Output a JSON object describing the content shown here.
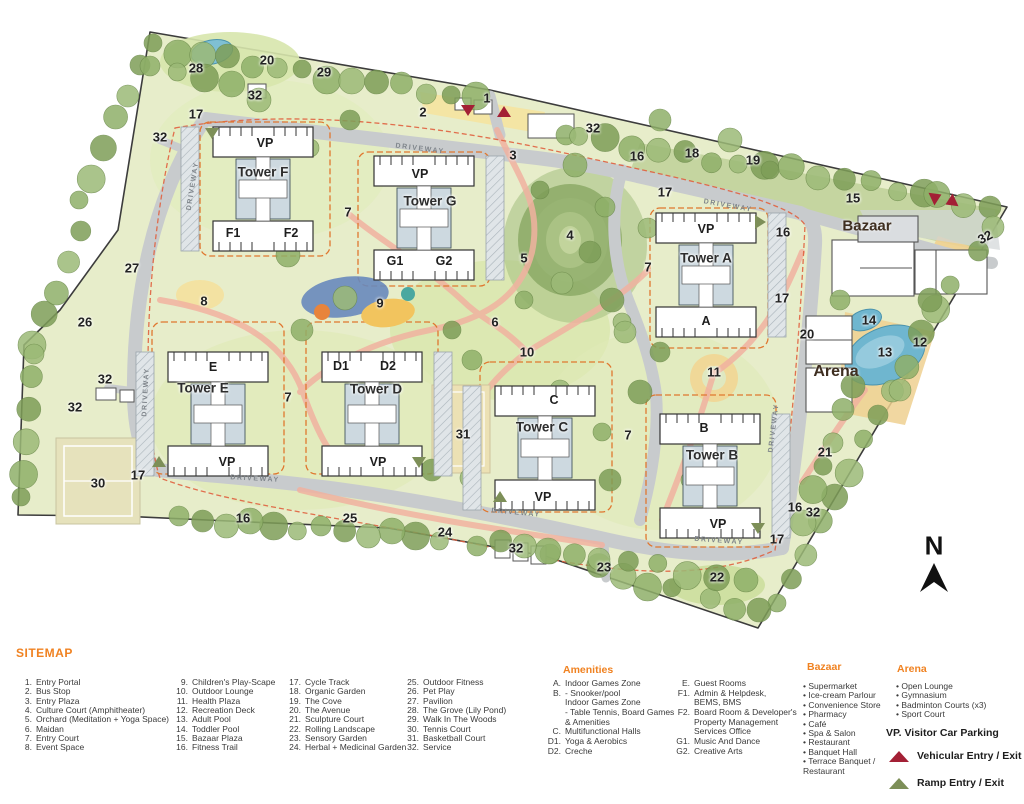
{
  "legend": {
    "title": "SITEMAP",
    "sitemap_items": [
      {
        "num": "1.",
        "label": "Entry Portal"
      },
      {
        "num": "2.",
        "label": "Bus Stop"
      },
      {
        "num": "3.",
        "label": "Entry Plaza"
      },
      {
        "num": "4.",
        "label": "Culture Court (Amphitheater)"
      },
      {
        "num": "5.",
        "label": "Orchard (Meditation + Yoga Space)"
      },
      {
        "num": "6.",
        "label": "Maidan"
      },
      {
        "num": "7.",
        "label": "Entry Court"
      },
      {
        "num": "8.",
        "label": "Event Space"
      },
      {
        "num": "9.",
        "label": "Children's Play-Scape"
      },
      {
        "num": "10.",
        "label": "Outdoor Lounge"
      },
      {
        "num": "11.",
        "label": "Health Plaza"
      },
      {
        "num": "12.",
        "label": "Recreation Deck"
      },
      {
        "num": "13.",
        "label": "Adult Pool"
      },
      {
        "num": "14.",
        "label": "Toddler Pool"
      },
      {
        "num": "15.",
        "label": "Bazaar Plaza"
      },
      {
        "num": "16.",
        "label": "Fitness Trail"
      },
      {
        "num": "17.",
        "label": "Cycle Track"
      },
      {
        "num": "18.",
        "label": "Organic Garden"
      },
      {
        "num": "19.",
        "label": "The Cove"
      },
      {
        "num": "20.",
        "label": "The Avenue"
      },
      {
        "num": "21.",
        "label": "Sculpture Court"
      },
      {
        "num": "22.",
        "label": "Rolling Landscape"
      },
      {
        "num": "23.",
        "label": "Sensory Garden"
      },
      {
        "num": "24.",
        "label": "Herbal + Medicinal Garden"
      },
      {
        "num": "25.",
        "label": "Outdoor Fitness"
      },
      {
        "num": "26.",
        "label": "Pet Play"
      },
      {
        "num": "27.",
        "label": "Pavilion"
      },
      {
        "num": "28.",
        "label": "The Grove (Lily Pond)"
      },
      {
        "num": "29.",
        "label": "Walk In The Woods"
      },
      {
        "num": "30.",
        "label": "Tennis Court"
      },
      {
        "num": "31.",
        "label": "Basketball Court"
      },
      {
        "num": "32.",
        "label": "Service"
      }
    ],
    "amenities": {
      "title": "Amenities",
      "items": [
        {
          "key": "A.",
          "lines": [
            "Indoor Games Zone"
          ]
        },
        {
          "key": "B.",
          "lines": [
            "- Snooker/pool",
            "Indoor Games Zone",
            "- Table Tennis, Board Games",
            "  & Amenities"
          ]
        },
        {
          "key": "C.",
          "lines": [
            "Multifunctional Halls"
          ]
        },
        {
          "key": "D1.",
          "lines": [
            "Yoga & Aerobics"
          ]
        },
        {
          "key": "D2.",
          "lines": [
            "Creche"
          ]
        }
      ]
    },
    "facilities": {
      "items": [
        {
          "key": "E.",
          "lines": [
            "Guest Rooms"
          ]
        },
        {
          "key": "F1.",
          "lines": [
            "Admin & Helpdesk,",
            "BEMS, BMS"
          ]
        },
        {
          "key": "F2.",
          "lines": [
            "Board Room & Developer's",
            "Property Management",
            "Services Office"
          ]
        },
        {
          "key": "G1.",
          "lines": [
            "Music And Dance"
          ]
        },
        {
          "key": "G2.",
          "lines": [
            "Creative Arts"
          ]
        }
      ]
    },
    "bazaar": {
      "title": "Bazaar",
      "items": [
        "Supermarket",
        "Ice-cream Parlour",
        "Convenience Store",
        "Pharmacy",
        "Café",
        "Spa & Salon",
        "Restaurant",
        "Banquet Hall",
        "Terrace Banquet /\nRestaurant"
      ]
    },
    "arena": {
      "title": "Arena",
      "items": [
        "Open Lounge",
        "Gymnasium",
        "Badminton Courts (x3)",
        "Sport Court"
      ]
    },
    "vp_note": "VP. Visitor Car Parking",
    "entries": [
      {
        "label": "Vehicular Entry / Exit",
        "color": "#a32035",
        "type": "vehicular"
      },
      {
        "label": "Ramp Entry / Exit",
        "color": "#7d8f58",
        "type": "ramp"
      }
    ]
  },
  "site_plan": {
    "compass": {
      "label": "N"
    },
    "area_labels": [
      {
        "t": "Bazaar",
        "x": 867,
        "y": 226,
        "s": 15
      },
      {
        "t": "Arena",
        "x": 836,
        "y": 372,
        "s": 16
      }
    ],
    "tower_labels": [
      {
        "t": "Tower F",
        "x": 263,
        "y": 172
      },
      {
        "t": "Tower G",
        "x": 430,
        "y": 201
      },
      {
        "t": "Tower A",
        "x": 706,
        "y": 258
      },
      {
        "t": "Tower E",
        "x": 203,
        "y": 388
      },
      {
        "t": "Tower D",
        "x": 376,
        "y": 389
      },
      {
        "t": "Tower C",
        "x": 542,
        "y": 427
      },
      {
        "t": "Tower B",
        "x": 712,
        "y": 455
      }
    ],
    "unit_labels": [
      {
        "t": "VP",
        "x": 265,
        "y": 143
      },
      {
        "t": "F1",
        "x": 233,
        "y": 233
      },
      {
        "t": "F2",
        "x": 291,
        "y": 233
      },
      {
        "t": "VP",
        "x": 420,
        "y": 174
      },
      {
        "t": "G1",
        "x": 395,
        "y": 261
      },
      {
        "t": "G2",
        "x": 444,
        "y": 261
      },
      {
        "t": "VP",
        "x": 706,
        "y": 229
      },
      {
        "t": "A",
        "x": 706,
        "y": 321
      },
      {
        "t": "E",
        "x": 213,
        "y": 367
      },
      {
        "t": "VP",
        "x": 227,
        "y": 462
      },
      {
        "t": "D1",
        "x": 341,
        "y": 366
      },
      {
        "t": "D2",
        "x": 388,
        "y": 366
      },
      {
        "t": "VP",
        "x": 378,
        "y": 462
      },
      {
        "t": "C",
        "x": 554,
        "y": 400
      },
      {
        "t": "VP",
        "x": 543,
        "y": 497
      },
      {
        "t": "B",
        "x": 704,
        "y": 428
      },
      {
        "t": "VP",
        "x": 718,
        "y": 524
      }
    ],
    "driveway_labels": [
      {
        "t": "DRIVEWAY",
        "x": 420,
        "y": 149,
        "r": 7
      },
      {
        "t": "DRIVEWAY",
        "x": 728,
        "y": 206,
        "r": 10
      },
      {
        "t": "DRIVEWAY",
        "x": 193,
        "y": 186,
        "r": -81
      },
      {
        "t": "DRIVEWAY",
        "x": 146,
        "y": 392,
        "r": -87
      },
      {
        "t": "DRIVEWAY",
        "x": 255,
        "y": 479,
        "r": 3
      },
      {
        "t": "DRIVEWAY",
        "x": 516,
        "y": 513,
        "r": 5
      },
      {
        "t": "DRIVEWAY",
        "x": 719,
        "y": 541,
        "r": 4
      },
      {
        "t": "DRIVEWAY",
        "x": 774,
        "y": 428,
        "r": -83
      }
    ],
    "markers": [
      {
        "t": "1",
        "x": 487,
        "y": 98
      },
      {
        "t": "2",
        "x": 423,
        "y": 112
      },
      {
        "t": "3",
        "x": 513,
        "y": 155
      },
      {
        "t": "4",
        "x": 570,
        "y": 235
      },
      {
        "t": "5",
        "x": 524,
        "y": 258
      },
      {
        "t": "6",
        "x": 495,
        "y": 322
      },
      {
        "t": "7",
        "x": 348,
        "y": 212
      },
      {
        "t": "7",
        "x": 648,
        "y": 267
      },
      {
        "t": "7",
        "x": 288,
        "y": 397
      },
      {
        "t": "7",
        "x": 628,
        "y": 435
      },
      {
        "t": "8",
        "x": 204,
        "y": 301
      },
      {
        "t": "9",
        "x": 380,
        "y": 303
      },
      {
        "t": "10",
        "x": 527,
        "y": 352
      },
      {
        "t": "11",
        "x": 714,
        "y": 372
      },
      {
        "t": "12",
        "x": 920,
        "y": 342
      },
      {
        "t": "13",
        "x": 885,
        "y": 352
      },
      {
        "t": "14",
        "x": 869,
        "y": 320
      },
      {
        "t": "15",
        "x": 853,
        "y": 198
      },
      {
        "t": "16",
        "x": 637,
        "y": 156
      },
      {
        "t": "16",
        "x": 783,
        "y": 232
      },
      {
        "t": "16",
        "x": 243,
        "y": 518
      },
      {
        "t": "16",
        "x": 795,
        "y": 507
      },
      {
        "t": "17",
        "x": 196,
        "y": 114
      },
      {
        "t": "17",
        "x": 665,
        "y": 192
      },
      {
        "t": "17",
        "x": 782,
        "y": 298
      },
      {
        "t": "17",
        "x": 138,
        "y": 475
      },
      {
        "t": "17",
        "x": 777,
        "y": 539
      },
      {
        "t": "18",
        "x": 692,
        "y": 153
      },
      {
        "t": "19",
        "x": 753,
        "y": 160
      },
      {
        "t": "20",
        "x": 267,
        "y": 60
      },
      {
        "t": "20",
        "x": 807,
        "y": 334
      },
      {
        "t": "21",
        "x": 825,
        "y": 452
      },
      {
        "t": "22",
        "x": 717,
        "y": 577
      },
      {
        "t": "23",
        "x": 604,
        "y": 567
      },
      {
        "t": "24",
        "x": 445,
        "y": 532
      },
      {
        "t": "25",
        "x": 350,
        "y": 518
      },
      {
        "t": "26",
        "x": 85,
        "y": 322
      },
      {
        "t": "27",
        "x": 132,
        "y": 268
      },
      {
        "t": "28",
        "x": 196,
        "y": 68
      },
      {
        "t": "29",
        "x": 324,
        "y": 72
      },
      {
        "t": "30",
        "x": 98,
        "y": 483
      },
      {
        "t": "31",
        "x": 463,
        "y": 434
      },
      {
        "t": "32",
        "x": 255,
        "y": 95
      },
      {
        "t": "32",
        "x": 160,
        "y": 137
      },
      {
        "t": "32",
        "x": 593,
        "y": 128
      },
      {
        "t": "32",
        "x": 985,
        "y": 237,
        "r": -28
      },
      {
        "t": "32",
        "x": 105,
        "y": 379
      },
      {
        "t": "32",
        "x": 75,
        "y": 407
      },
      {
        "t": "32",
        "x": 516,
        "y": 548
      },
      {
        "t": "32",
        "x": 813,
        "y": 512
      }
    ]
  },
  "colors": {
    "heading_orange": "#f08221",
    "vehicular_red": "#a32035",
    "ramp_green": "#7d8f58",
    "cluster_dash_orange": "#e0772f",
    "pool_blue": "#6fb6cf"
  }
}
